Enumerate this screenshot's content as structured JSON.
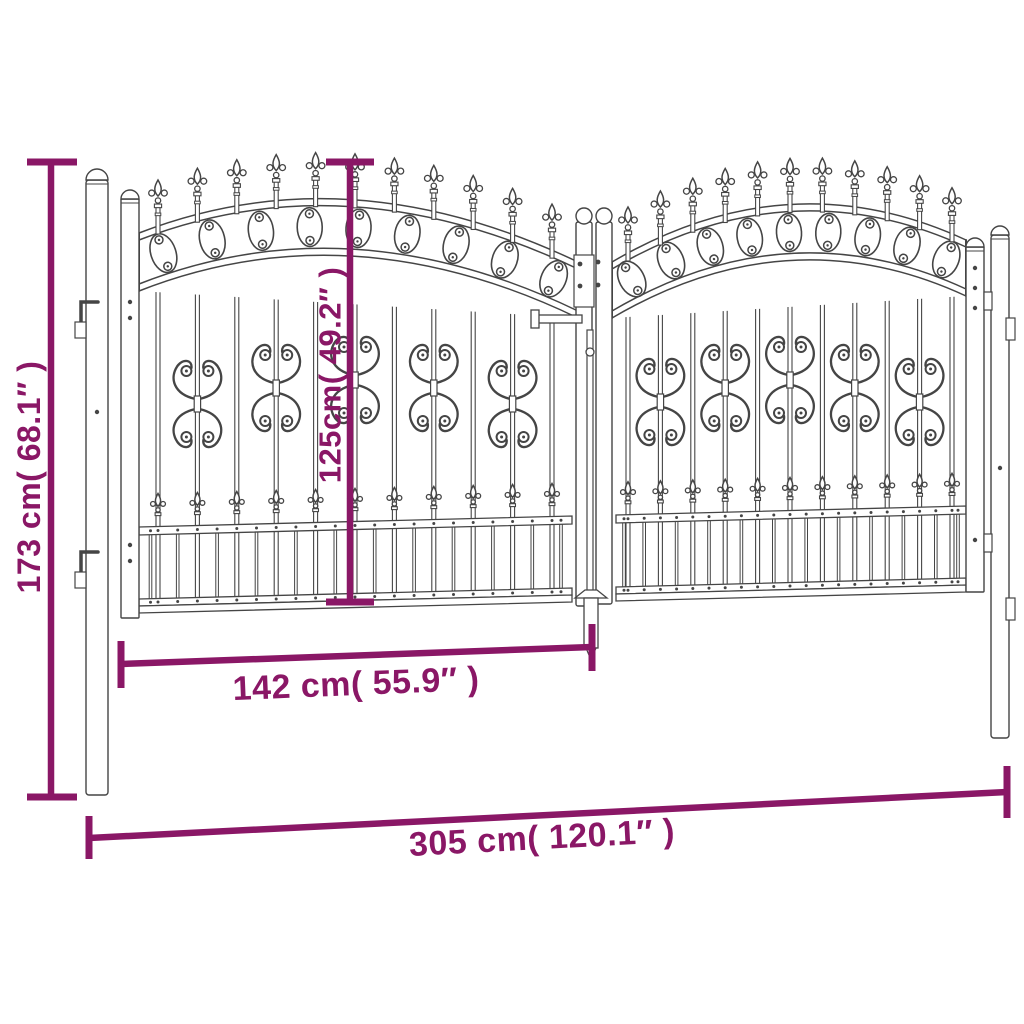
{
  "diagram": {
    "dimensions": {
      "total_height": "173 cm( 68.1″ )",
      "inner_height": "125cm( 49.2″ )",
      "leaf_width": "142 cm( 55.9″ )",
      "total_width": "305 cm( 120.1″ )"
    },
    "colors": {
      "dimension": "#8A1766",
      "line_art": "#454545",
      "background": "#FFFFFF"
    }
  }
}
